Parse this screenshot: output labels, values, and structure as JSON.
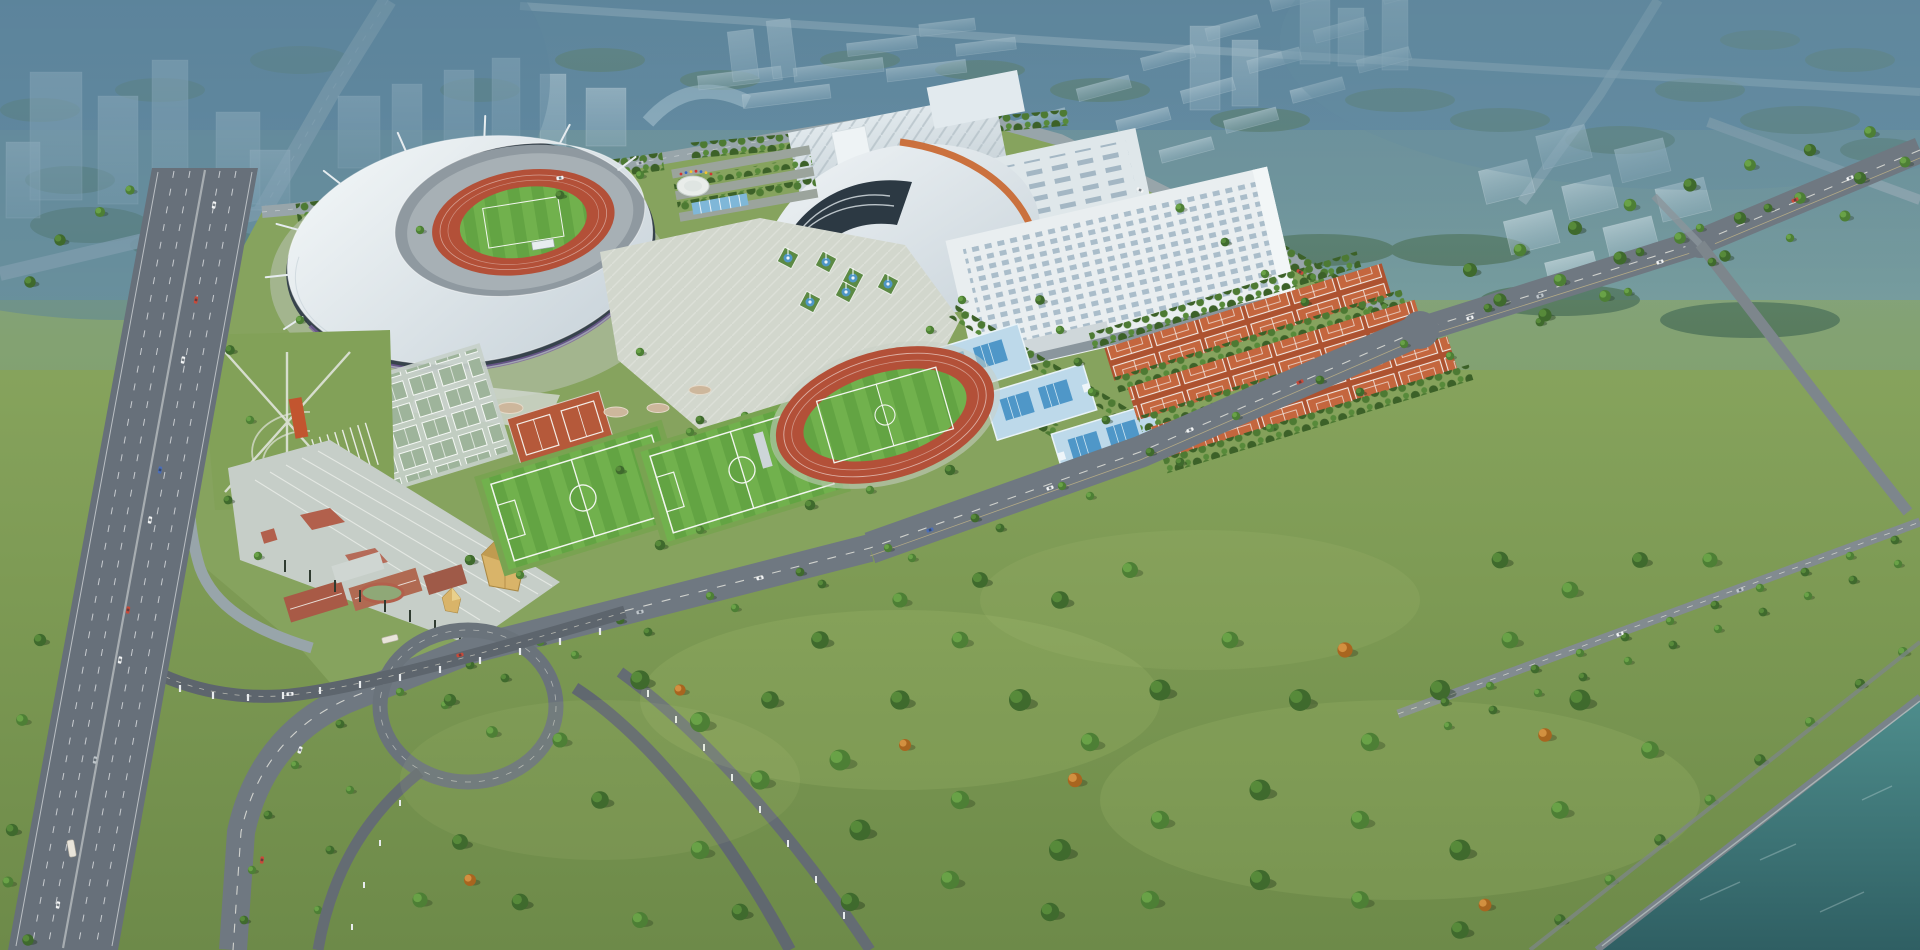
{
  "scene": {
    "type": "aerial-architectural-rendering",
    "labels": {
      "sky_haze": "Hazy blue dusk fog over distant city",
      "city_skyline": "Translucent massing of future city blocks and towers",
      "city_roads": "Distant avenues and expressway fading into fog",
      "stadium": "Main stadium with white crescent tensile roof and masts",
      "stadium_field": "Stadium bowl with athletics track and turf pitch",
      "practice_track": "Warm-up athletics track north-west of stadium",
      "exhibition_center": "Long exhibition hall with ridged roof",
      "sports_arena": "Indoor arena with swooping roof and orange band",
      "convention_hall": "Rear hall with rows of skylights",
      "indoor_arena_hall": "Flat-roof indoor hall with skylight grid",
      "central_plaza": "Paved celebration plaza between venues",
      "fountains": "Fountain pools with diamond planting beds",
      "flag_circle": "Circular flag plaza beside parking grove",
      "parking_grove": "Tree-shaded parking rows",
      "pool_terraces": "Terraced outdoor swimming pools",
      "tennis_courts": "Rows of clay tennis courts between tree lines",
      "training_fields": "Soccer training pitches with mown stripes",
      "athletics_track": "Outdoor competition athletics track",
      "outdoor_courts": "Grid of outdoor basketball courts",
      "leisure_lawn": "Lawn with crossing footpaths and sand strips",
      "event_plaza": "Terraced south entry plaza",
      "golden_pavilion": "Faceted golden pavilion",
      "clubhouse_buildings": "Low clubhouse buildings with terracotta roofs",
      "north_road": "Boundary road behind the venues",
      "west_road": "Tree-lined western access road",
      "boulevard": "Main landscaped boulevard crossing the site",
      "interchange": "Looped ramp interchange with elevated busway",
      "busway_viaduct": "Elevated viaduct on piers",
      "expressway": "Multi-lane urban expressway",
      "crossroad": "Secondary road towards the riverside",
      "park_road": "Straight tree-lined park road",
      "forest_park": "Riverside forest park with tree clusters",
      "river": "Teal river along the south-east corner",
      "riverside_embankment": "Stone embankment along the river",
      "vehicles": "Cars and buses on the road network"
    },
    "counts": {
      "soccer_training_fields": 2,
      "pool_terraces": 3,
      "tennis_court_rows": 3,
      "fountain_pools": 6,
      "stadium_masts": 9,
      "interchange_loops": 1
    }
  },
  "palette": {
    "fog_top": "#4c7690",
    "fog_mid": "#6c96a8",
    "haze": "#7fa5b2",
    "grass_complex": "#86a35e",
    "grass_park": "#7d9a54",
    "grass_park_deep": "#6d8a49",
    "tree_dark": "#3f6a2d",
    "tree_mid": "#578a3a",
    "tree_light": "#69a247",
    "tree_autumn": "#d29040",
    "road": "#6f7881",
    "highway": "#67707a",
    "ramp": "#646c73",
    "road_light": "#98a5aa",
    "roof_white": "#e9eef1",
    "roof_shade": "#c9d3d9",
    "glass_dark": "#37434c",
    "track_red": "#b35038",
    "pitch_green": "#68a846",
    "pitch_stripe": "#71b14d",
    "tennis_clay": "#c4663e",
    "court_green": "#9eb49b",
    "pool_deck": "#bdd9ea",
    "pool_water": "#4f97c8",
    "plaza": "#d2d7cd",
    "plaza_steps": "#c6cec8",
    "gold": "#d9b469",
    "red_roof": "#a85a46",
    "accent_purple": "#7b5ea1",
    "arena_orange": "#c96a35",
    "water": "#35696c",
    "water_light": "#4e8d8c",
    "marking_white": "#f2f6ef"
  }
}
